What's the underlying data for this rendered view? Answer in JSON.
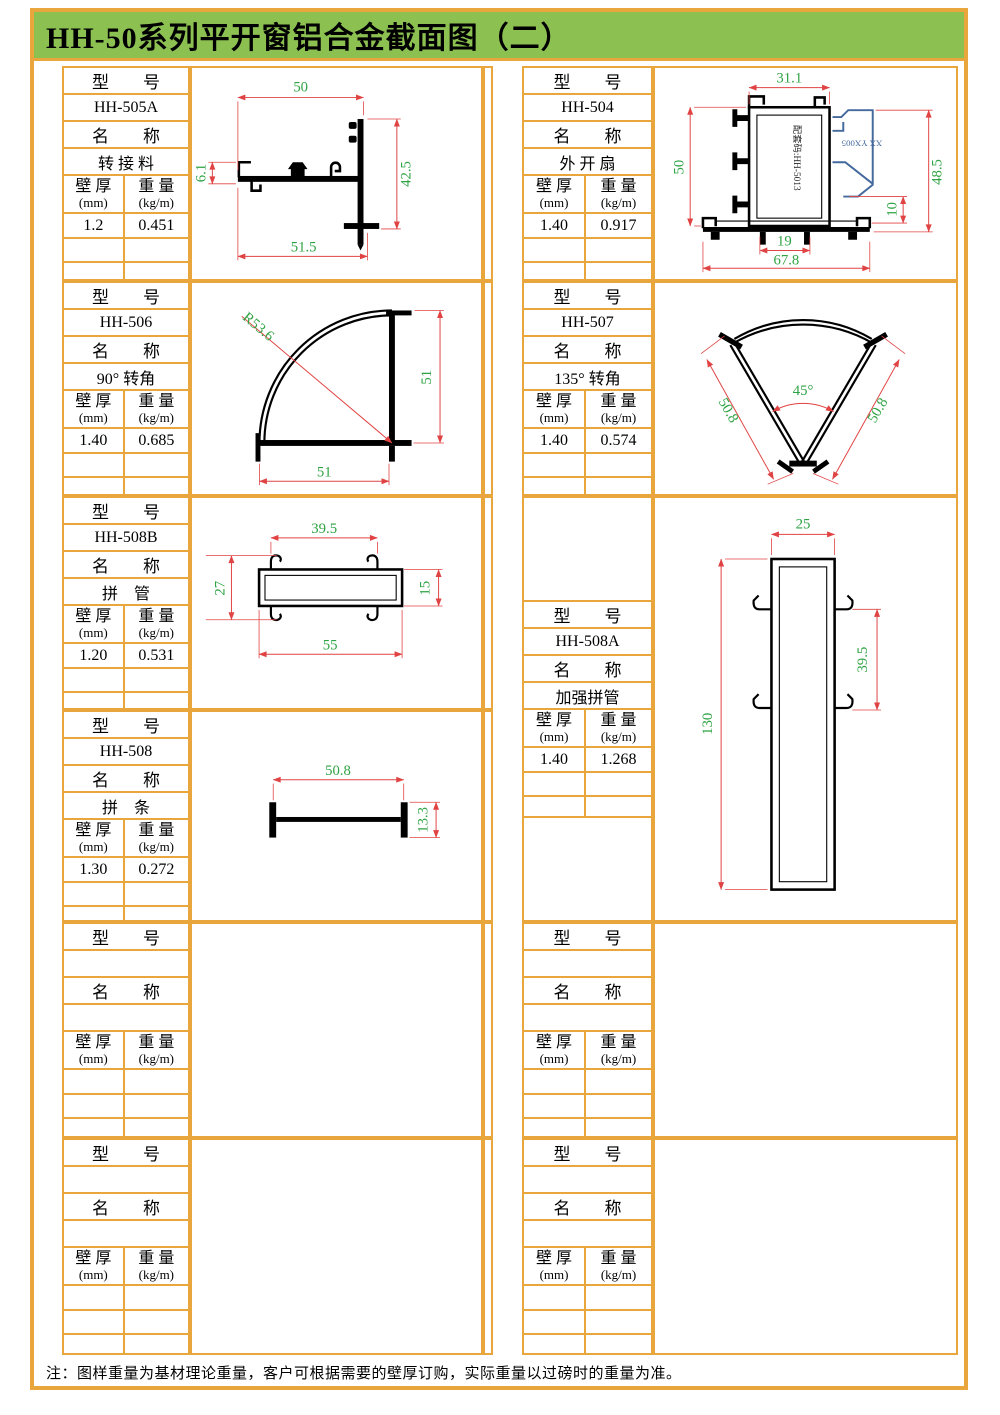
{
  "page": {
    "title": "HH-50系列平开窗铝合金截面图（二）",
    "footer_note": "注：图样重量为基材理论重量，客户可根据需要的壁厚订购，实际重量以过磅时的重量为准。"
  },
  "labels": {
    "model": "型　　号",
    "name": "名　　称",
    "thickness": "壁 厚",
    "thickness_unit": "(mm)",
    "weight": "重 量",
    "weight_unit": "(kg/m)"
  },
  "colors": {
    "grid_orange": "#E9A63C",
    "title_green": "#8CC152",
    "dim_red": "#E04343",
    "dim_green": "#2FA344",
    "profile_black": "#000000",
    "overlay_blue": "#44699D"
  },
  "cells": [
    {
      "model": "HH-505A",
      "name": "转 接 料",
      "thickness": "1.2",
      "weight": "0.451",
      "dims": {
        "top": "50",
        "left": "6.1",
        "right": "42.5",
        "bottom": "51.5"
      }
    },
    {
      "model": "HH-504",
      "name": "外 开 扇",
      "thickness": "1.40",
      "weight": "0.917",
      "dims": {
        "top": "31.1",
        "left": "50",
        "right": "48.5",
        "gap": "10",
        "bottom_inner": "19",
        "bottom": "67.8"
      },
      "notes": {
        "inner_code": "配套码:HH-5013",
        "blue_label": "XX YX005"
      }
    },
    {
      "model": "HH-506",
      "name": "90° 转角",
      "thickness": "1.40",
      "weight": "0.685",
      "dims": {
        "radius": "R53.6",
        "right": "51",
        "bottom": "51"
      }
    },
    {
      "model": "HH-507",
      "name": "135° 转角",
      "thickness": "1.40",
      "weight": "0.574",
      "dims": {
        "angle": "45°",
        "left": "50.8",
        "right": "50.8"
      }
    },
    {
      "model": "HH-508B",
      "name": "拼　管",
      "thickness": "1.20",
      "weight": "0.531",
      "dims": {
        "top": "39.5",
        "left": "27",
        "right": "15",
        "bottom": "55"
      }
    },
    {
      "model": "HH-508A",
      "name": "加强拼管",
      "thickness": "1.40",
      "weight": "1.268",
      "dims": {
        "top": "25",
        "left": "130",
        "right": "39.5"
      }
    },
    {
      "model": "HH-508",
      "name": "拼　条",
      "thickness": "1.30",
      "weight": "0.272",
      "dims": {
        "top": "50.8",
        "right": "13.3"
      }
    },
    {
      "model": "",
      "name": "",
      "thickness": "",
      "weight": ""
    },
    {
      "model": "",
      "name": "",
      "thickness": "",
      "weight": ""
    },
    {
      "model": "",
      "name": "",
      "thickness": "",
      "weight": ""
    },
    {
      "model": "",
      "name": "",
      "thickness": "",
      "weight": ""
    }
  ]
}
